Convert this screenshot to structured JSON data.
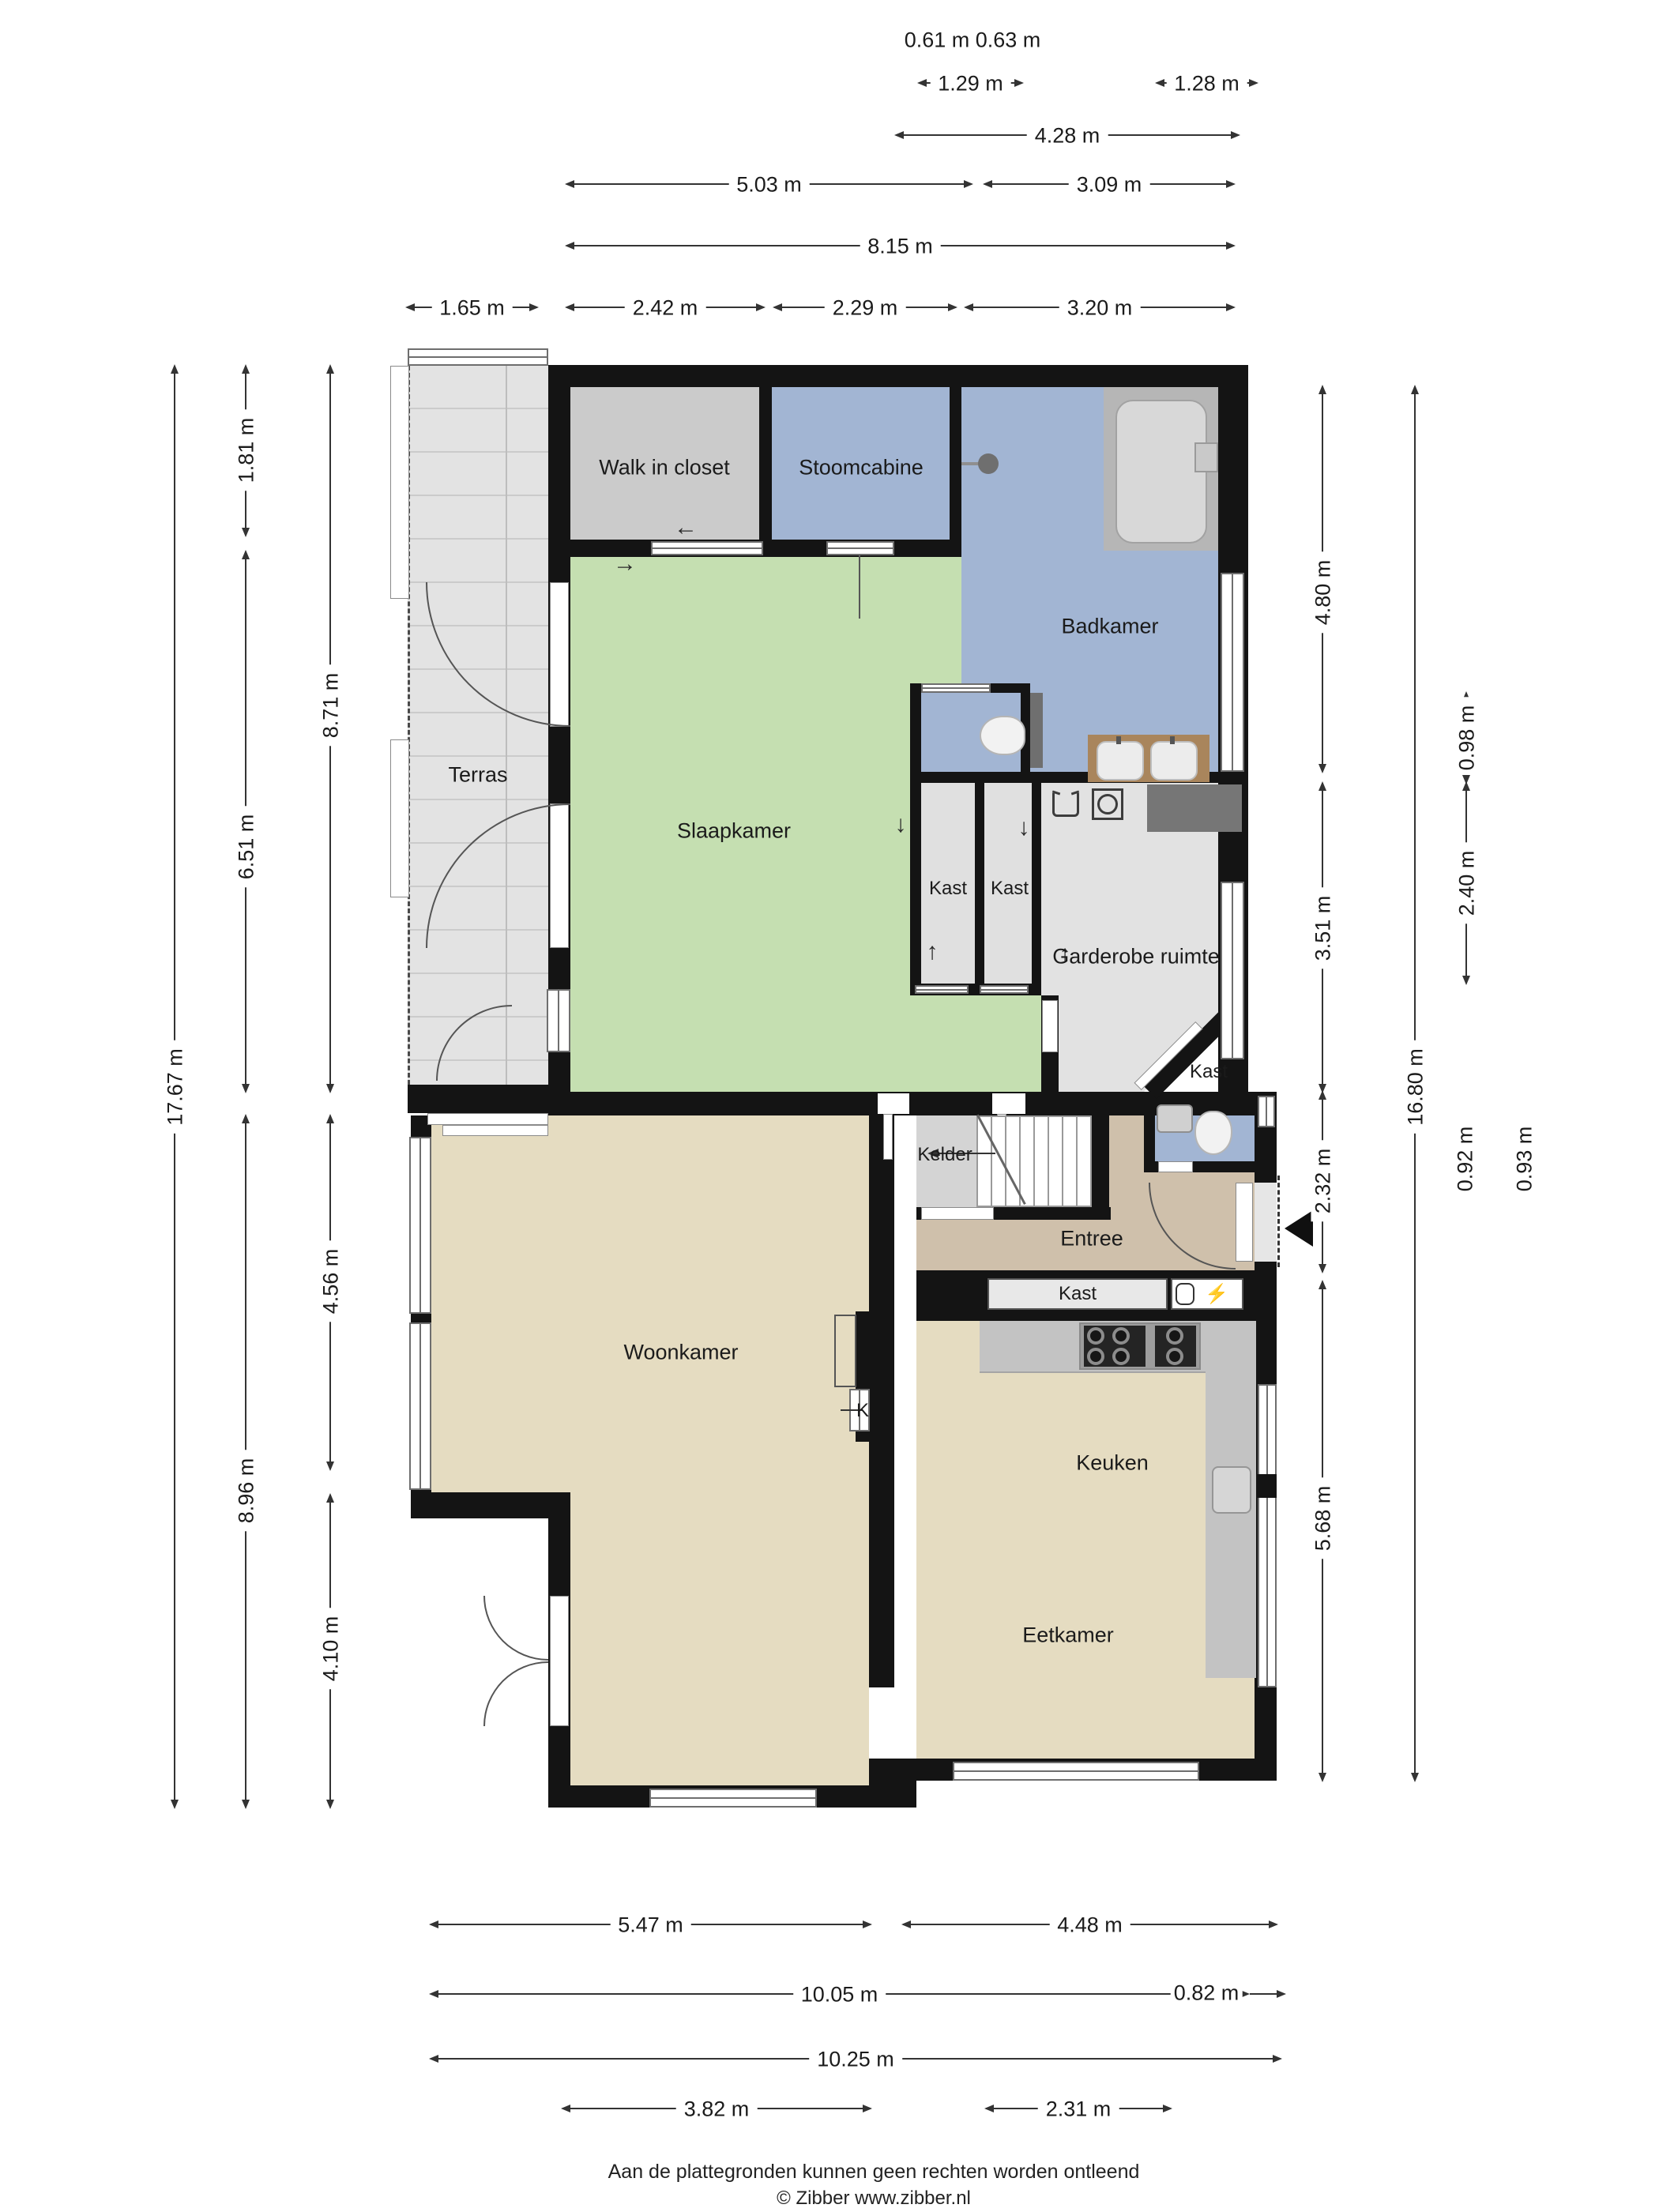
{
  "rooms": {
    "walk_in_closet": "Walk in closet",
    "stoomcabine": "Stoomcabine",
    "badkamer": "Badkamer",
    "terras": "Terras",
    "slaapkamer": "Slaapkamer",
    "kast1": "Kast",
    "kast2": "Kast",
    "garderobe": "Garderobe ruimte",
    "kast_hoek": "Kast",
    "kelder": "Kelder",
    "entree": "Entree",
    "kast_gang": "Kast",
    "woonkamer": "Woonkamer",
    "keuken": "Keuken",
    "eetkamer": "Eetkamer",
    "kast_k": "K"
  },
  "dims": {
    "top": [
      "0.61 m",
      "0.63 m",
      "1.29 m",
      "1.28 m",
      "4.28 m",
      "5.03 m",
      "3.09 m",
      "8.15 m",
      "1.65 m",
      "2.42 m",
      "2.29 m",
      "3.20 m"
    ],
    "left": [
      "17.67 m",
      "1.81 m",
      "6.51 m",
      "8.96 m",
      "8.71 m",
      "4.56 m",
      "4.10 m"
    ],
    "right": [
      "4.80 m",
      "3.51 m",
      "2.32 m",
      "5.68 m",
      "16.80 m",
      "0.98 m",
      "2.40 m",
      "0.92 m",
      "0.93 m"
    ],
    "bottom": [
      "5.47 m",
      "4.48 m",
      "10.05 m",
      "0.82 m",
      "10.25 m",
      "3.82 m",
      "2.31 m"
    ]
  },
  "glyphs": {
    "arrow_left": "←",
    "arrow_right": "→",
    "arrow_up": "↑",
    "arrow_down": "↓",
    "bolt": "⚡"
  },
  "footer": {
    "disclaimer": "Aan de plattegronden kunnen geen rechten worden ontleend",
    "copyright": "© Zibber www.zibber.nl"
  },
  "colors": {
    "wall": "#141414",
    "bedroom_green": "#c5dfb1",
    "bathroom_blue": "#a2b5d3",
    "closet_gray": "#cbcbcb",
    "wardrobe_gray": "#e2e2e2",
    "living_tan": "#e5dcc1",
    "entry_tan": "#cfc0ab",
    "terrace_gray": "#e3e3e3",
    "counter_gray": "#c3c3c3",
    "cabinet_dark": "#767676",
    "vanity_brown": "#a9855c"
  }
}
